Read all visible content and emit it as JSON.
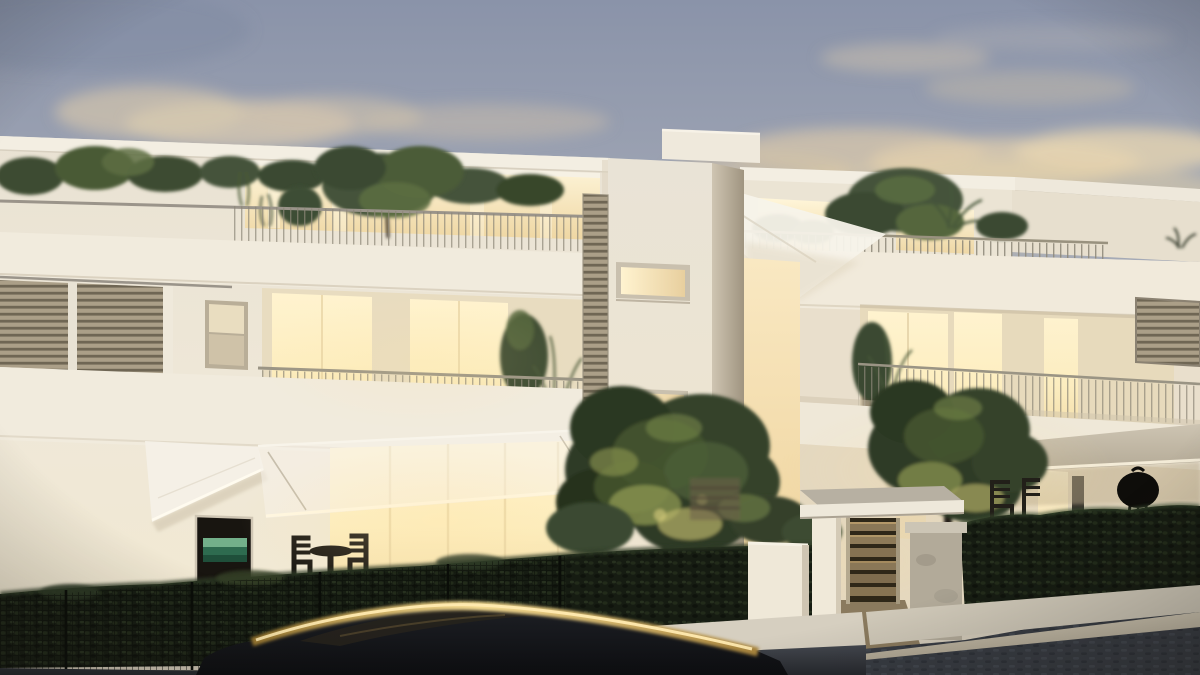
{
  "scene": {
    "type": "architectural-dusk-render",
    "subject": "Modern three-storey apartment complex at dusk with warmly lit interiors, roof gardens, garden trees, entrance gate, hedge and a parked car in the foreground",
    "time_of_day": "dusk",
    "text_content": "none"
  },
  "palette": {
    "skyTop": "#8a93a9",
    "skyMid": "#aaaeb9",
    "skyHorizon": "#d8cfbd",
    "cloudWarm": "#e2cfae",
    "facade": "#f0e9da",
    "facadeShadow": "#cfc5b2",
    "windowGlow": "#fff4d4",
    "windowDeep": "#f0d9a5",
    "louvreSlat": "#ab9f88",
    "railing": "#98917f",
    "foliageDark": "#2f3b27",
    "foliageLit": "#b8b468",
    "hedge": "#161c12",
    "awningWhite": "#f4f0e7",
    "awningTan": "#c3b9a6",
    "gateWood": "#8a7757",
    "stonePillar": "#b2aa99",
    "road": "#34383e",
    "curb": "#c2bbaa",
    "carBody": "#14161a",
    "carReflection": "#f2d690",
    "artworkGreen": "#2e6b4f"
  },
  "objects": [
    {
      "name": "dusk-sky",
      "desc": "blue-grey evening sky with warm lit clouds"
    },
    {
      "name": "left-apartment-block",
      "desc": "three-storey cream block with roof garden, lit terraces and louvre screens"
    },
    {
      "name": "stair-tower",
      "desc": "central stair tower, two lit slit windows, vertical louvre strip, rooftop box"
    },
    {
      "name": "right-apartment-block",
      "desc": "penthouse with roof terrace railing, plants, balcony and louvre panel"
    },
    {
      "name": "shade-sail",
      "desc": "white shade sail spanning between tower and right block"
    },
    {
      "name": "awnings",
      "desc": "translucent white awnings over ground floor, tan awning on right block"
    },
    {
      "name": "entrance-gate",
      "desc": "white canopy on pillars, wooden slat gate, stone pier"
    },
    {
      "name": "garden-trees",
      "desc": "two uplit garden trees between the blocks"
    },
    {
      "name": "boundary-hedge",
      "desc": "dark clipped hedge with wire mesh fence and posts"
    },
    {
      "name": "bistro-set",
      "desc": "small round table with two chairs silhouetted on lit terrace"
    },
    {
      "name": "bbq-grill",
      "desc": "kettle barbecue silhouette on right terrace"
    },
    {
      "name": "street",
      "desc": "dark asphalt sidewalk with light stone curb"
    },
    {
      "name": "parked-car",
      "desc": "dark car roof with golden dusk reflection"
    }
  ]
}
